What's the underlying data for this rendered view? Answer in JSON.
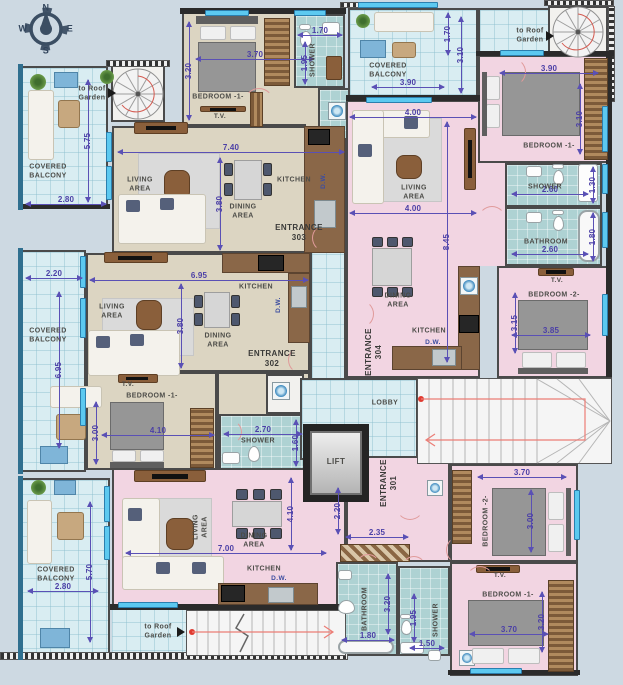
{
  "texts": {
    "covered_balcony": "COVERED BALCONY",
    "to_roof_garden": "to Roof Garden",
    "bedroom_1": "BEDROOM -1-",
    "bedroom_2": "BEDROOM -2-",
    "shower": "SHOWER",
    "bathroom": "BATHROOM",
    "living_area": "LIVING AREA",
    "dining_area": "DINING AREA",
    "kitchen": "KITCHEN",
    "dw": "D.W.",
    "tv": "T.V.",
    "lobby": "LOBBY",
    "lift": "LIFT",
    "entrance_301": "ENTRANCE 301",
    "entrance_302": "ENTRANCE 302",
    "entrance_303": "ENTRANCE 303",
    "entrance_304": "ENTRANCE 304"
  },
  "compass": {
    "n": "N",
    "e": "E",
    "s": "S",
    "w": "W"
  },
  "dims": {
    "tl_bed_w": "3.70",
    "tl_bed_h": "3.20",
    "tl_shower_w": "1.70",
    "tl_shower_h": "1.95",
    "tl_living_w": "7.40",
    "tl_living_h": "3.80",
    "tl_balc_h": "5.75",
    "tl_balc_w": "2.80",
    "ml_living_w": "6.95",
    "ml_living_h": "3.80",
    "ml_balc_w": "2.20",
    "ml_balc_h": "6.95",
    "ml_bed_h": "3.00",
    "ml_bed_w": "4.10",
    "ml_shower_w": "2.70",
    "ml_shower_h": "1.60",
    "r_living_w1": "4.00",
    "r_living_w2": "4.00",
    "r_living_h": "8.45",
    "r_balc_w": "3.90",
    "r_balc_h1": "1.70",
    "r_balc_h2": "3.10",
    "r_bed1_w": "3.90",
    "r_bed1_h": "3.10",
    "r_shower_w": "2.60",
    "r_shower_h": "1.30",
    "r_bath_w": "2.60",
    "r_bath_h": "1.80",
    "r_bed2_h": "3.15",
    "r_bed2_w": "3.85",
    "b_living_w": "7.00",
    "b_living_h": "4.10",
    "b_ward_w": "2.35",
    "b_hall_h": "2.20",
    "b_bath_h": "3.20",
    "b_bath_w": "1.80",
    "b_shower_h": "1.95",
    "b_shower_w": "1.50",
    "b_balc_h": "5.70",
    "b_balc_w": "2.80",
    "b_bed2_w": "3.70",
    "b_bed2_h": "3.00",
    "b_bed1_w": "3.70",
    "b_bed1_h": "3.20"
  },
  "colors": {
    "wall": "#3f3f3f",
    "dim": "#4b3fa6",
    "floor_beige": "#dcd5c2",
    "floor_pink": "#f2d5e2",
    "tile": "#d9edf2",
    "bath_tile": "#aed2d3",
    "window": "#5cc9f0",
    "route_red": "#e03a30"
  }
}
